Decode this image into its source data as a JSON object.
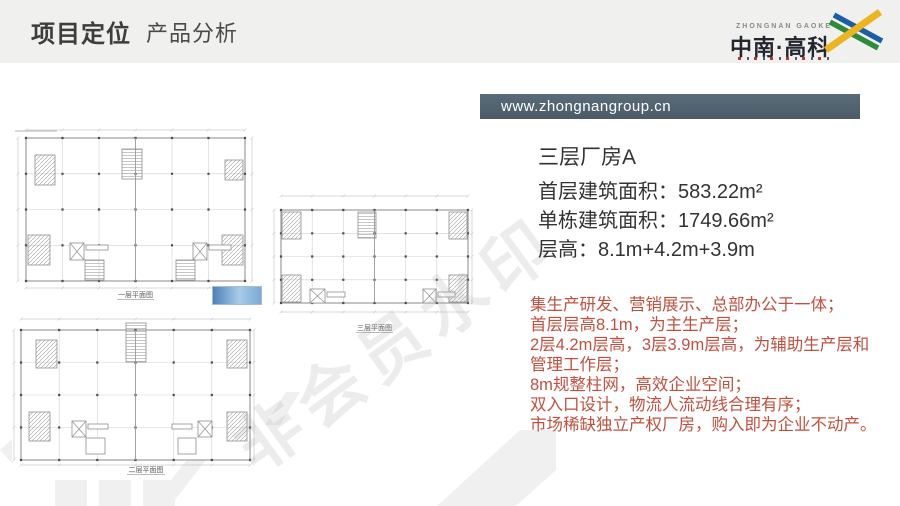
{
  "slide": {
    "header": {
      "title_primary": "项目定位",
      "title_secondary": "产品分析"
    },
    "logo": {
      "name_en": "ZHONGNAN GAOKE",
      "name_cn": "中南·高科"
    },
    "banner": {
      "url": "www.zhongnangroup.cn"
    },
    "product": {
      "title": "三层厂房A",
      "specs": [
        "首层建筑面积：583.22m²",
        "单栋建筑面积：1749.66m²",
        "层高：8.1m+4.2m+3.9m"
      ]
    },
    "features": [
      "集生产研发、营销展示、总部办公于一体；",
      "首层层高8.1m，为主生产层；",
      "2层4.2m层高，3层3.9m层高，为辅助生产层和",
      "管理工作层；",
      "8m规整柱网，高效企业空间；",
      "双入口设计，物流人流动线合理有序；",
      "市场稀缺独立产权厂房，购入即为企业不动产。"
    ],
    "plans": [
      {
        "label": "一层平面图"
      },
      {
        "label": "三层平面图"
      },
      {
        "label": "二层平面图"
      }
    ],
    "watermark": {
      "text": "非会员水印"
    },
    "colors": {
      "feature_text": "#C1503F",
      "banner_bg": "#52636F",
      "highlight_bar": "#5B93C9",
      "logo_yellow": "#ECB520",
      "logo_green": "#2E8B3A",
      "logo_blue": "#1D5CA8"
    }
  }
}
